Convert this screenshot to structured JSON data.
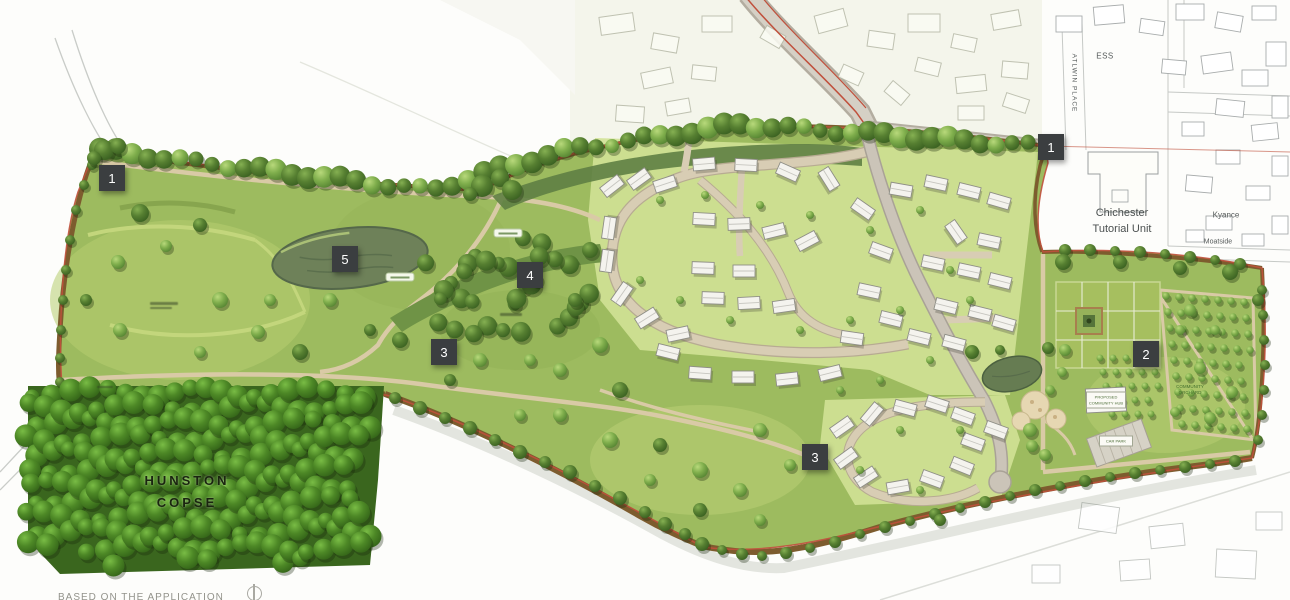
{
  "map_labels": {
    "hunston_copse_line1": "HUNSTON",
    "hunston_copse_line2": "COPSE",
    "chichester_line1": "Chichester",
    "chichester_line2": "Tutorial Unit",
    "kyance": "Kyance",
    "moatside": "Moatside",
    "ess": "ESS",
    "atlwin_place": "ATLWIN PLACE",
    "community_hub_line1": "PROPOSED",
    "community_hub_line2": "COMMUNITY HUB",
    "car_park": "CAR PARK",
    "orchard_line1": "COMMUNITY",
    "orchard_line2": "ORCHARD"
  },
  "legend_markers": [
    {
      "label": "1"
    },
    {
      "label": "1"
    },
    {
      "label": "2"
    },
    {
      "label": "3"
    },
    {
      "label": "3"
    },
    {
      "label": "4"
    },
    {
      "label": "5"
    }
  ],
  "caption": "BASED ON THE APPLICATION",
  "colors": {
    "marker_bg": "#3b3e40",
    "marker_text": "#ffffff",
    "boundary_red": "#c0503c",
    "hedgerow_brown": "#7d5c2e"
  }
}
